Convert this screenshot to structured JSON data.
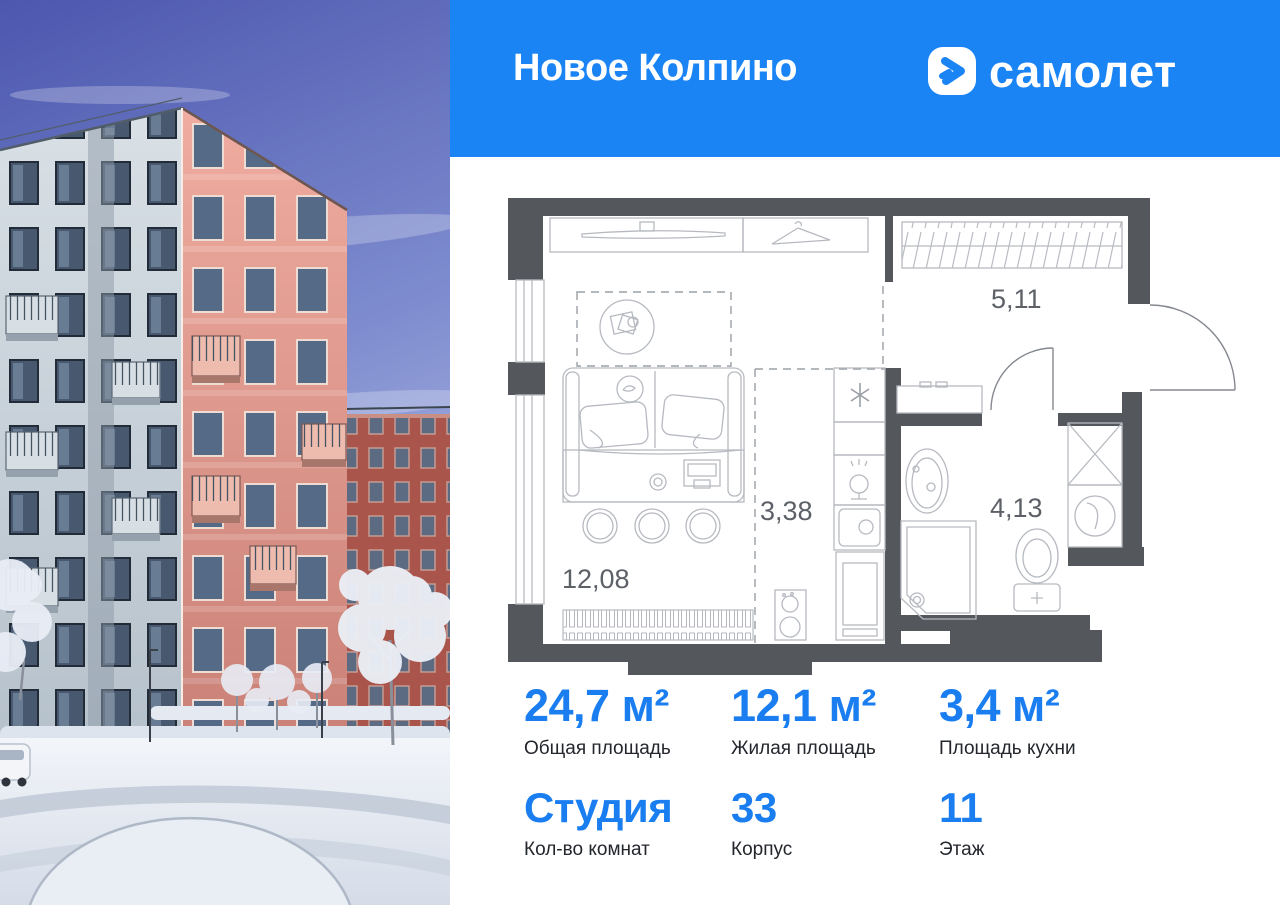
{
  "header": {
    "project_name": "Новое Колпино",
    "brand_name": "самолет"
  },
  "floor_plan": {
    "living": {
      "name": "living-room",
      "area": "12,08"
    },
    "kitchen": {
      "name": "kitchen-zone",
      "area": "3,38"
    },
    "hallway": {
      "name": "hallway",
      "area": "5,11"
    },
    "bathroom": {
      "name": "bathroom",
      "area": "4,13"
    }
  },
  "stats": {
    "total_area": {
      "value": "24,7 м²",
      "label": "Общая площадь"
    },
    "living_area": {
      "value": "12,1 м²",
      "label": "Жилая площадь"
    },
    "kitchen_area": {
      "value": "3,4 м²",
      "label": "Площадь кухни"
    },
    "rooms": {
      "value": "Студия",
      "label": "Кол-во комнат"
    },
    "building": {
      "value": "33",
      "label": "Корпус"
    },
    "floor": {
      "value": "11",
      "label": "Этаж"
    }
  },
  "colors": {
    "brand_blue": "#1b84f5",
    "stat_number_blue": "#1a7ef0",
    "plan_wall_gray": "#54575c"
  }
}
